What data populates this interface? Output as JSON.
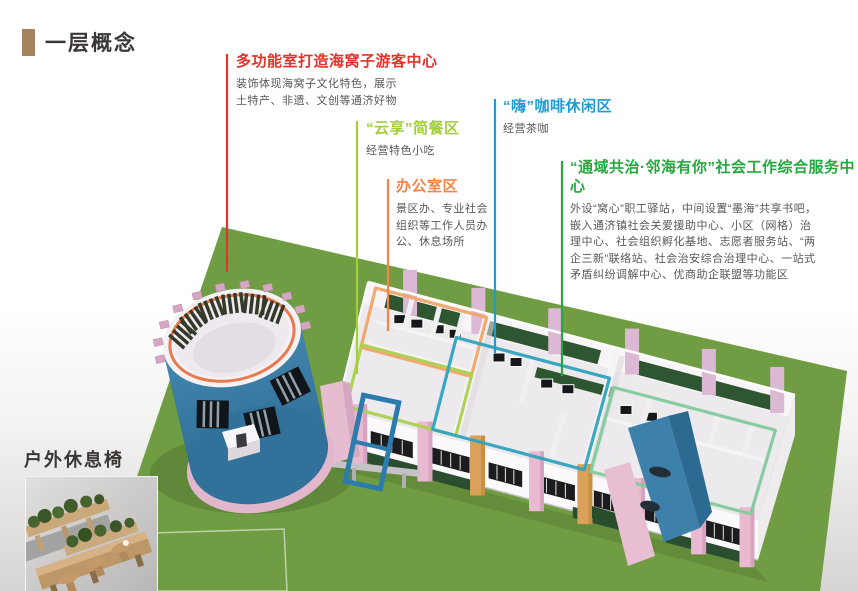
{
  "page": {
    "title": "一层概念"
  },
  "annotations": [
    {
      "id": "visitor-center",
      "color": "#e5332a",
      "title": "多功能室打造海窝子游客中心",
      "desc": "装饰体现海窝子文化特色，展示\n土特产、非遗、文创等通济好物"
    },
    {
      "id": "snack-bar",
      "color": "#a3cf3b",
      "title": "“云享”简餐区",
      "desc": "经营特色小吃"
    },
    {
      "id": "coffee-lounge",
      "color": "#1f9cd8",
      "title": "“嗨”咖啡休闲区",
      "desc": "经营茶咖"
    },
    {
      "id": "office-area",
      "color": "#f58345",
      "title": "办公室区",
      "desc": "景区办、专业社会\n组织等工作人员办\n公、休息场所"
    },
    {
      "id": "service-center",
      "color": "#23a93f",
      "title": "“通域共治·邻海有你”社会工作综合服务中心",
      "desc": "外设“窝心”职工驿站，中间设置“墨海”共享书吧，\n嵌入通济镇社会关爱援助中心、小区（网格）治\n理中心、社会组织孵化基地、志愿者服务站、“两\n企三新”联络站、社会治安综合治理中心、一站式\n矛盾纠纷调解中心、优商助企联盟等功能区"
    }
  ],
  "inset": {
    "label": "户外休息椅"
  },
  "scene": {
    "colors": {
      "grass": "#74a23e",
      "tower_blue": "#3a7ca5",
      "tower_ring_orange": "#e87a4e",
      "rim_pink": "#d4a6c2",
      "zone_orange": "#f2a467",
      "zone_yellow_green": "#abd14e",
      "zone_teal": "#2fa3be",
      "zone_mint": "#82cb9c",
      "pillar_pink": "#e9bacf",
      "pillar_tan": "#dba158",
      "hedge_green": "#2e5631",
      "wall_white": "#f6f3f6",
      "floor": "#edeaee"
    }
  }
}
